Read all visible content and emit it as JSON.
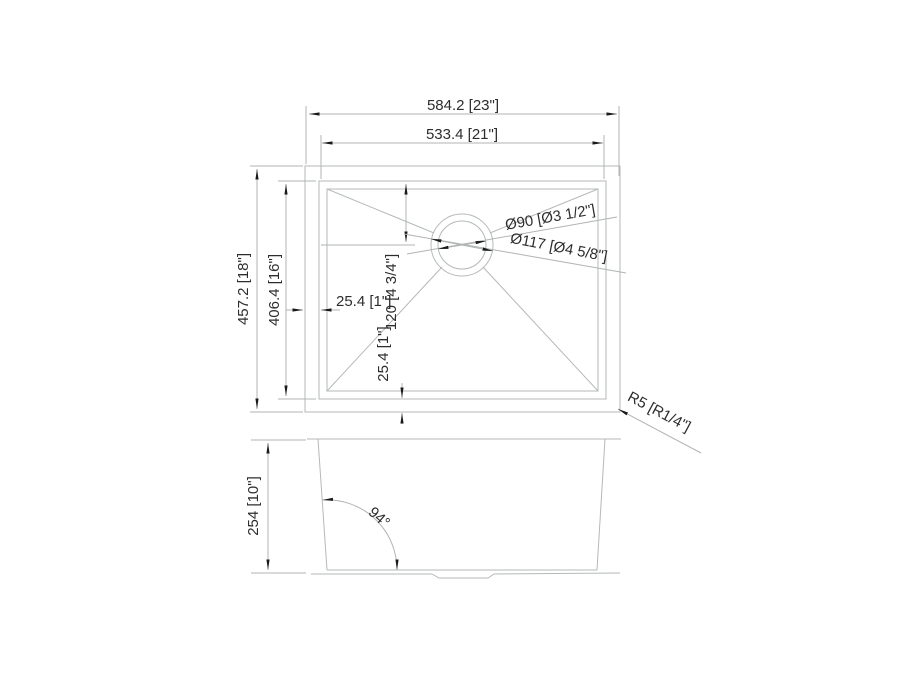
{
  "drawing": {
    "type": "sink-technical-drawing",
    "background": "#ffffff",
    "line_color": "#b5b9b9",
    "text_color": "#2d2d2d",
    "arrow_color": "#1a1a1a",
    "top_view": {
      "overall_width": "584.2  [23\"]",
      "bowl_width": "533.4 [21\"]",
      "overall_depth": "457.2 [18\"]",
      "bowl_depth": "406.4 [16\"]",
      "rim_offset_left": "25.4 [1\"]",
      "drain_center_from_top": "120 [4 3/4\"]",
      "rim_offset_bottom": "25.4 [1\"]",
      "drain_inner_diameter": "Ø90 [Ø3 1/2\"]",
      "drain_outer_diameter": "Ø117 [Ø4 5/8\"]",
      "corner_radius": "R5 [R1/4\"]"
    },
    "front_view": {
      "bowl_height": "254 [10\"]",
      "wall_angle": "94°"
    }
  }
}
